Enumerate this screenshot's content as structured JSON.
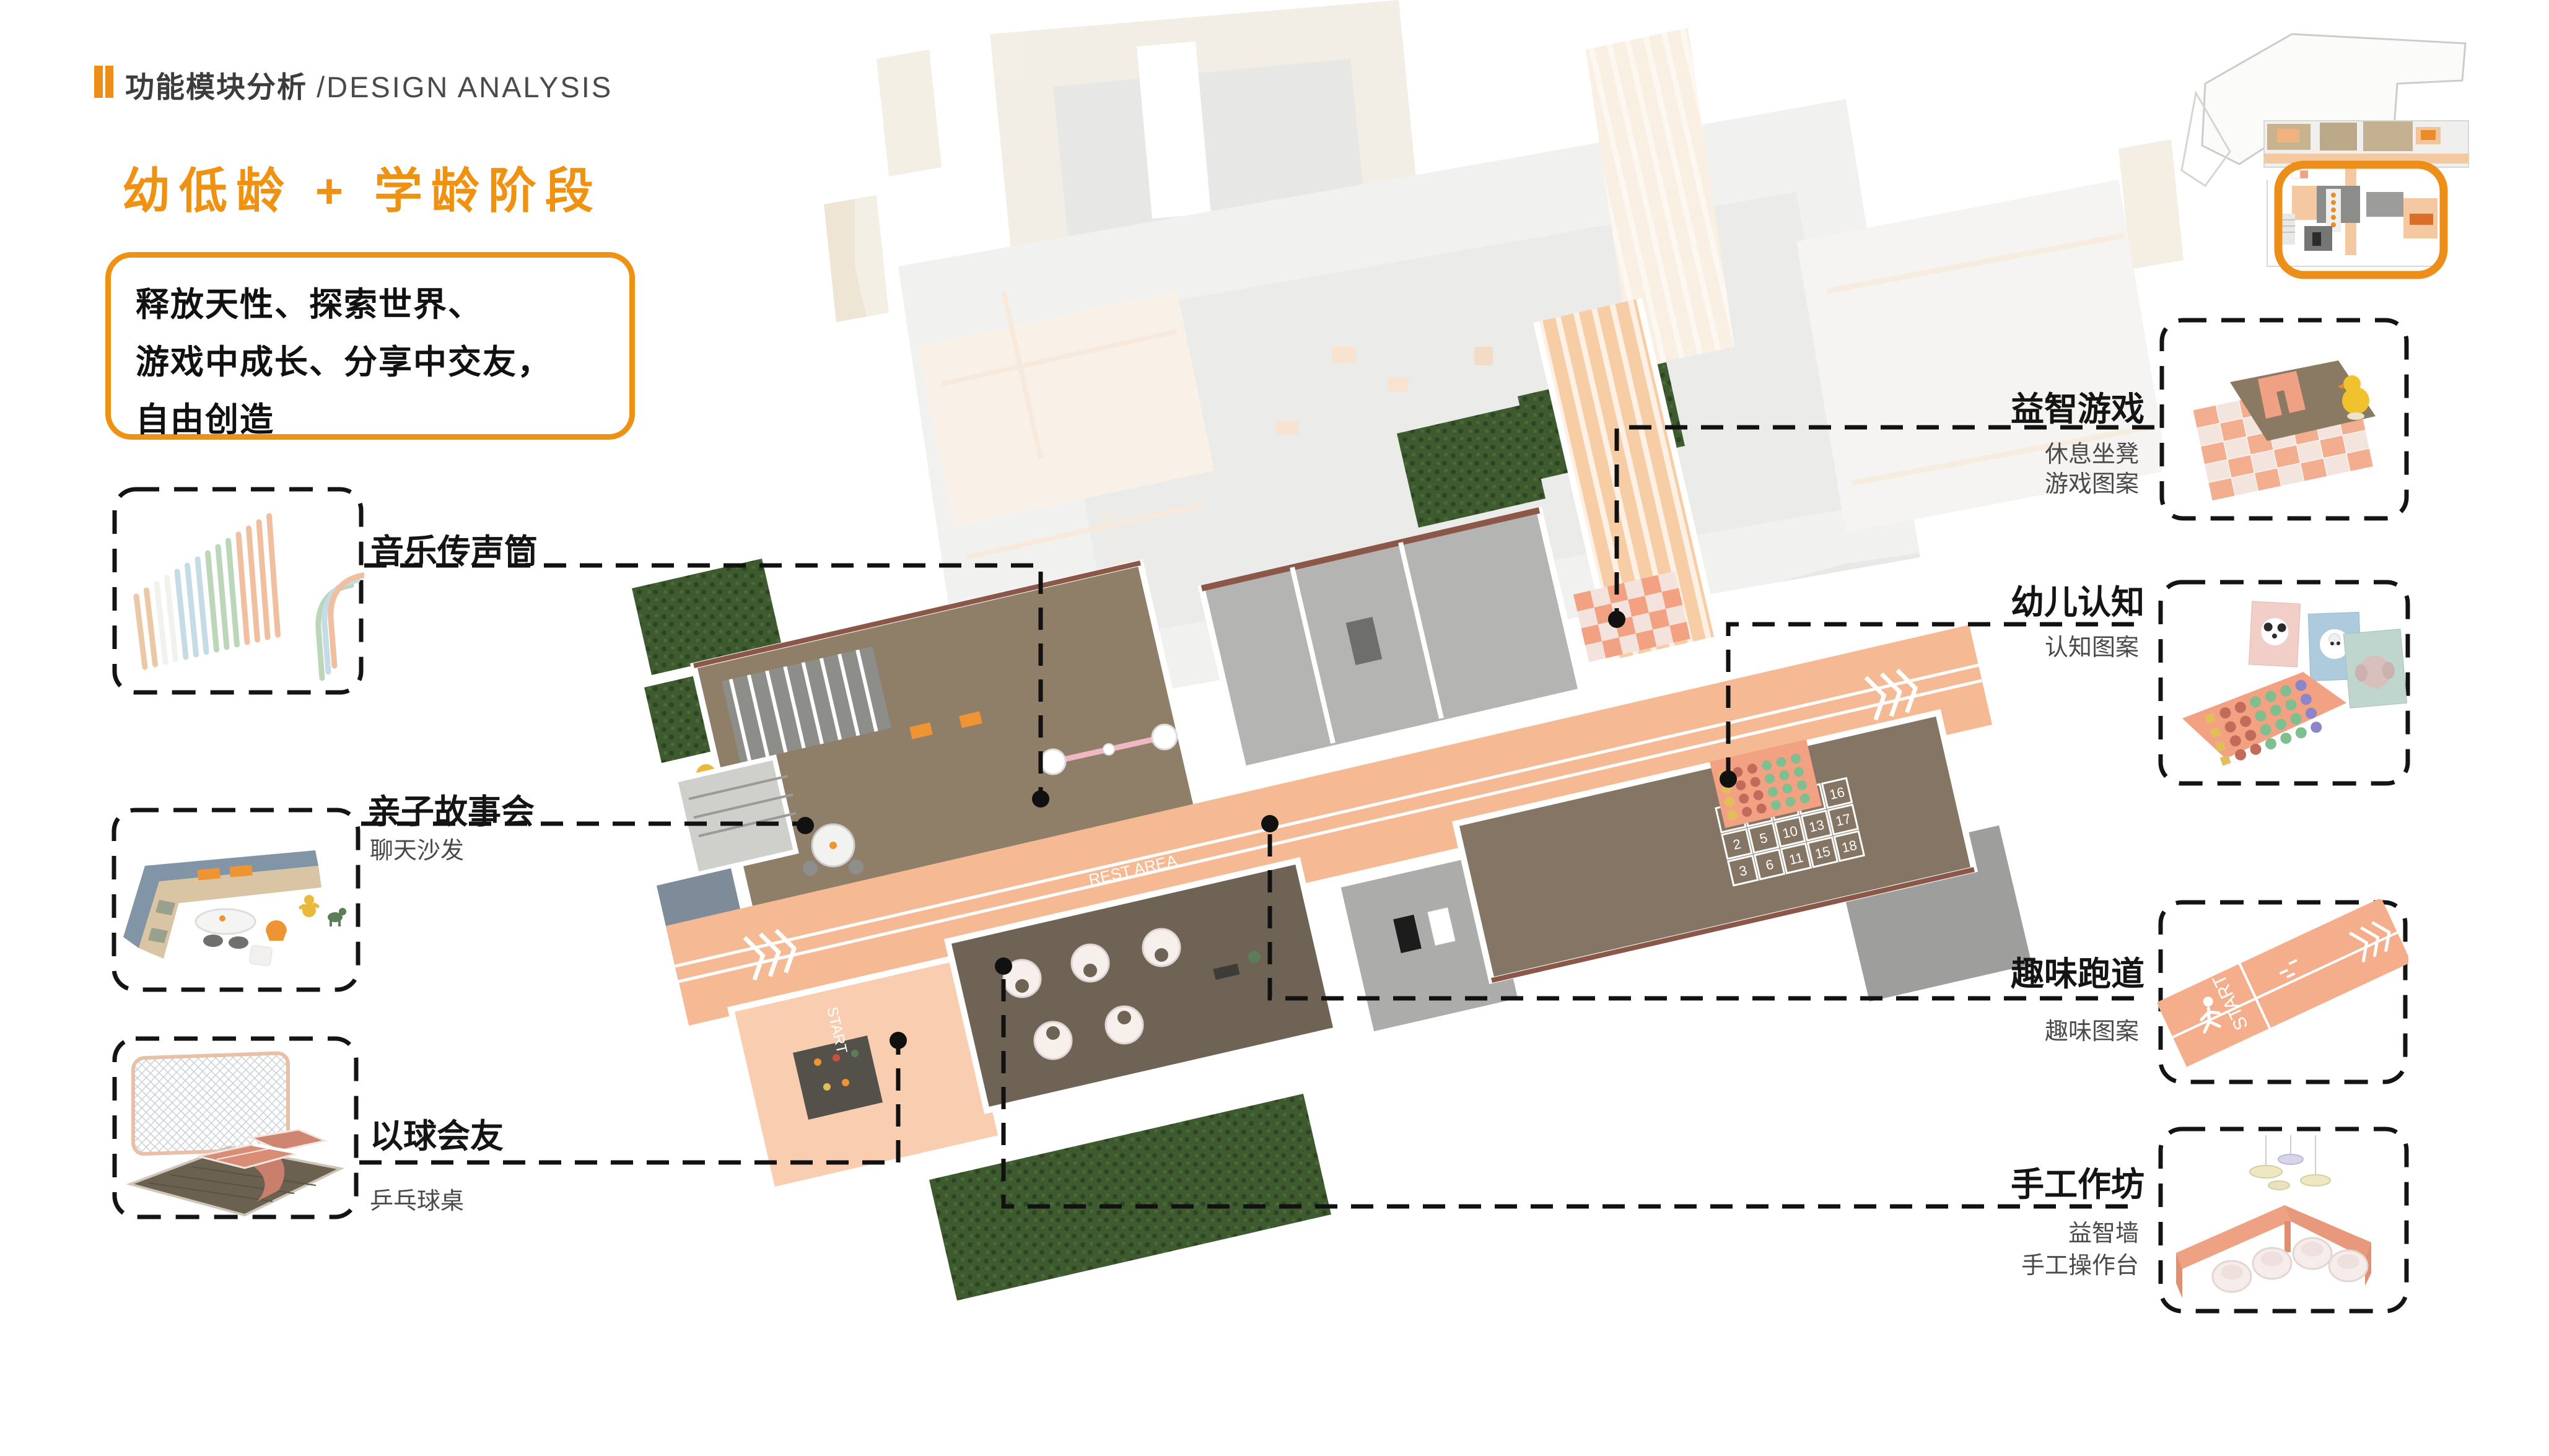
{
  "header": {
    "section_zh": "功能模块分析",
    "section_en": "/DESIGN ANALYSIS"
  },
  "stage_title": "幼低龄 + 学龄阶段",
  "description": {
    "line1": "释放天性、探索世界、",
    "line2": "游戏中成长、分享中交友，",
    "line3": "自由创造"
  },
  "left_features": [
    {
      "label": "音乐传声筒",
      "sub": ""
    },
    {
      "label": "亲子故事会",
      "sub": "聊天沙发"
    },
    {
      "label": "以球会友",
      "sub": "乒乓球桌"
    }
  ],
  "right_features": [
    {
      "label": "益智游戏",
      "sub1": "休息坐凳",
      "sub2": "游戏图案"
    },
    {
      "label": "幼儿认知",
      "sub1": "认知图案",
      "sub2": ""
    },
    {
      "label": "趣味跑道",
      "sub1": "趣味图案",
      "sub2": ""
    },
    {
      "label": "手工作坊",
      "sub1": "益智墙",
      "sub2": "手工操作台"
    }
  ],
  "plan": {
    "track_text_rest": "REST AREA",
    "track_text_start": "START",
    "ghost_text_1": "LET'S DO",
    "ghost_text_2": "WEST AREA",
    "hopscotch_numbers": [
      "1",
      "2",
      "3",
      "4",
      "5",
      "6",
      "7",
      "10",
      "11",
      "12",
      "13",
      "15",
      "16",
      "17",
      "18"
    ]
  },
  "illustrations": {
    "track_text": "START"
  },
  "colors": {
    "accent": "#EF9212",
    "track_salmon": "#F5BA93",
    "deck_wood": "#8F7E68",
    "hedge_green": "#3E5A2F",
    "wall_brick": "#8A5748",
    "leader_black": "#111111"
  }
}
